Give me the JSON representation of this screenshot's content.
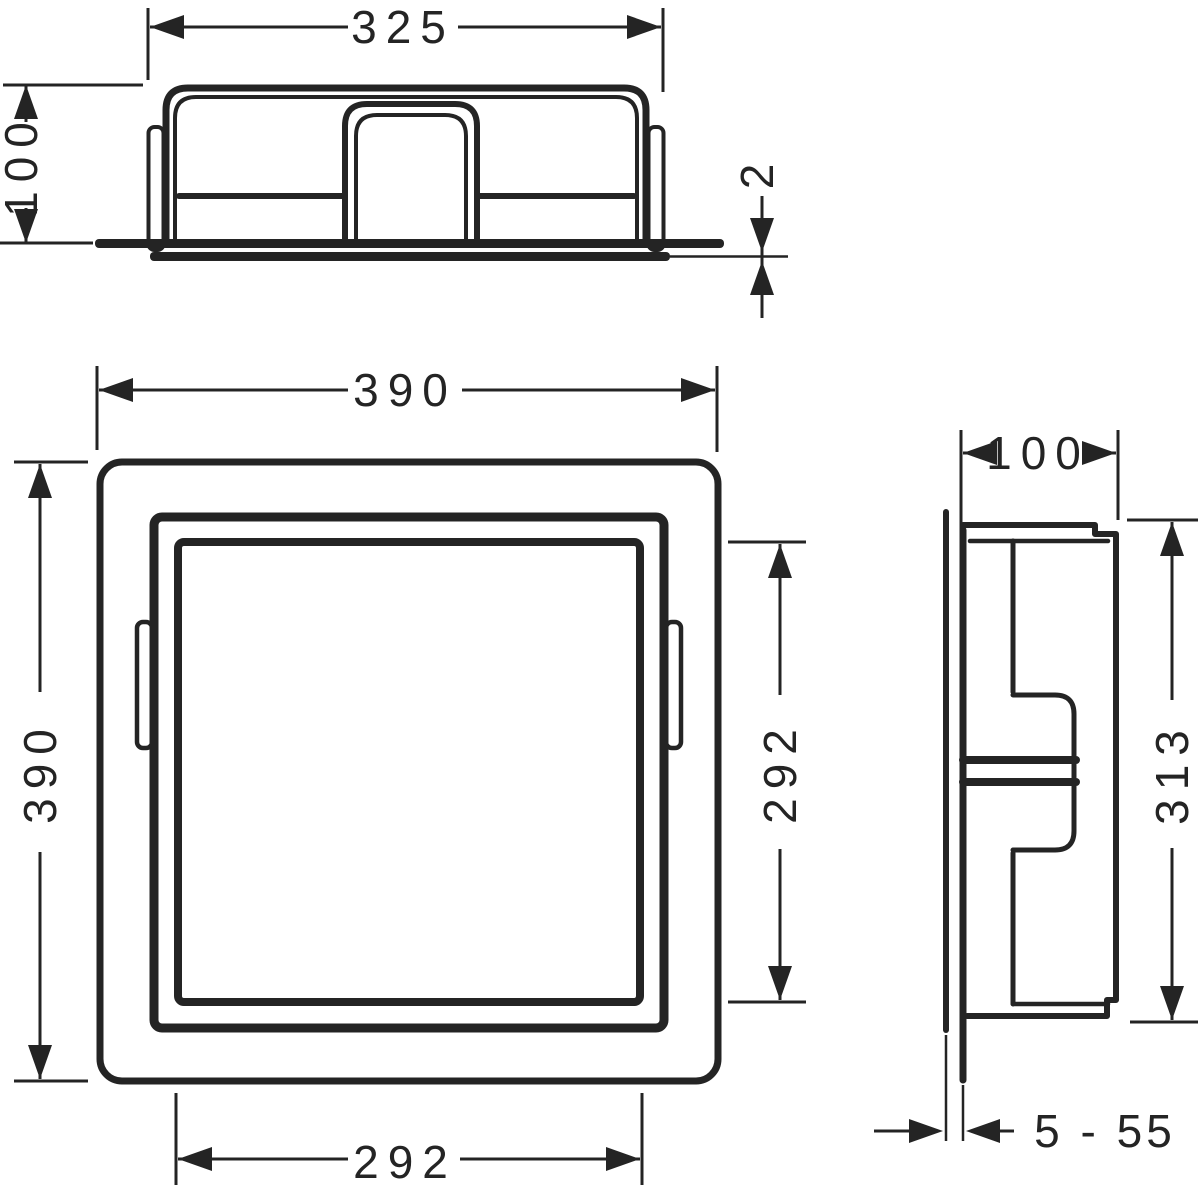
{
  "dimensions": {
    "top_width": "325",
    "top_depth": "100",
    "flange_thickness": "2",
    "front_width": "390",
    "front_height": "390",
    "opening_height": "292",
    "opening_width": "292",
    "side_depth": "100",
    "side_height": "313",
    "tile_buildup_range": "5 - 55"
  },
  "colors": {
    "line": "#242424",
    "background": "#ffffff"
  }
}
